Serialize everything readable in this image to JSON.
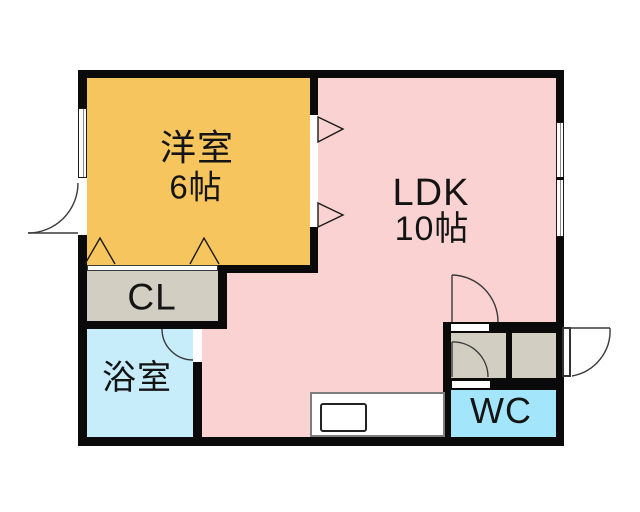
{
  "plan": {
    "type": "apartment-floor-plan",
    "rooms": [
      {
        "name": "western-room",
        "label": "洋室",
        "size": "6帖",
        "color": "#F7C55E"
      },
      {
        "name": "ldk",
        "label": "LDK",
        "size": "10帖",
        "color": "#FAD2D2"
      },
      {
        "name": "closet",
        "label": "CL",
        "size": "",
        "color": "#D2CFC2"
      },
      {
        "name": "bathroom",
        "label": "浴室",
        "size": "",
        "color": "#C7EDFA"
      },
      {
        "name": "toilet",
        "label": "WC",
        "size": "",
        "color": "#A3E5FA"
      },
      {
        "name": "hallway",
        "label": "",
        "size": "",
        "color": "#D2CFC2"
      }
    ],
    "wall_color": "#0A0A0A",
    "features": [
      "exterior-door-left",
      "entrance-door-right",
      "window-left-wall",
      "window-right-wall",
      "closet-folding-doors",
      "partition-opening-triangles",
      "bathroom-door",
      "hall-door",
      "wc-door",
      "kitchen-counter",
      "kitchen-sink"
    ]
  }
}
